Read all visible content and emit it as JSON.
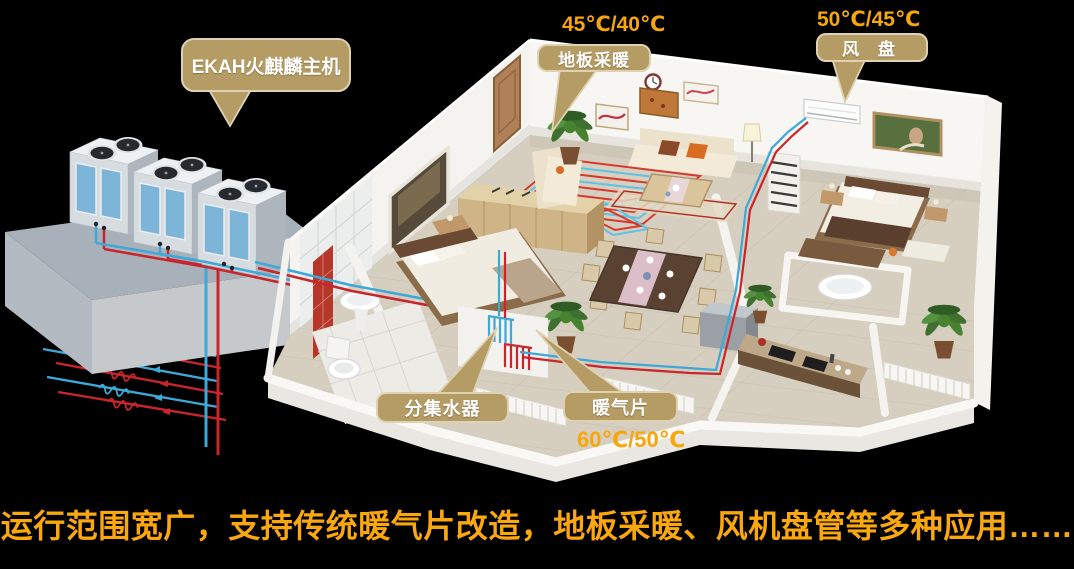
{
  "scene": {
    "labels": {
      "main_unit": "EKAH火麒麟主机",
      "floor_heating": "地板采暖",
      "fan_coil": "风 盘",
      "manifold": "分集水器",
      "radiator": "暖气片"
    },
    "temperatures": {
      "floor_heating": "45℃/40℃",
      "fan_coil": "50℃/45℃",
      "radiator": "60℃/50℃"
    },
    "caption": "运行范围宽广，支持传统暖气片改造，地板采暖、风机盘管等多种应用……",
    "colors": {
      "background": "#000000",
      "bubble_fill": "#b59b64",
      "bubble_border": "#ded2b2",
      "temperature_text": "#f7a60d",
      "caption_text": "#fba70e",
      "hot_pipe": "#c9252c",
      "cold_pipe": "#3ea8d8",
      "coil_hot": "#d63a2c",
      "coil_cold": "#5fc2e2",
      "platform": "#a8b1b9",
      "wall": "#f4f3ef",
      "floor": "#d6cfc0"
    }
  }
}
